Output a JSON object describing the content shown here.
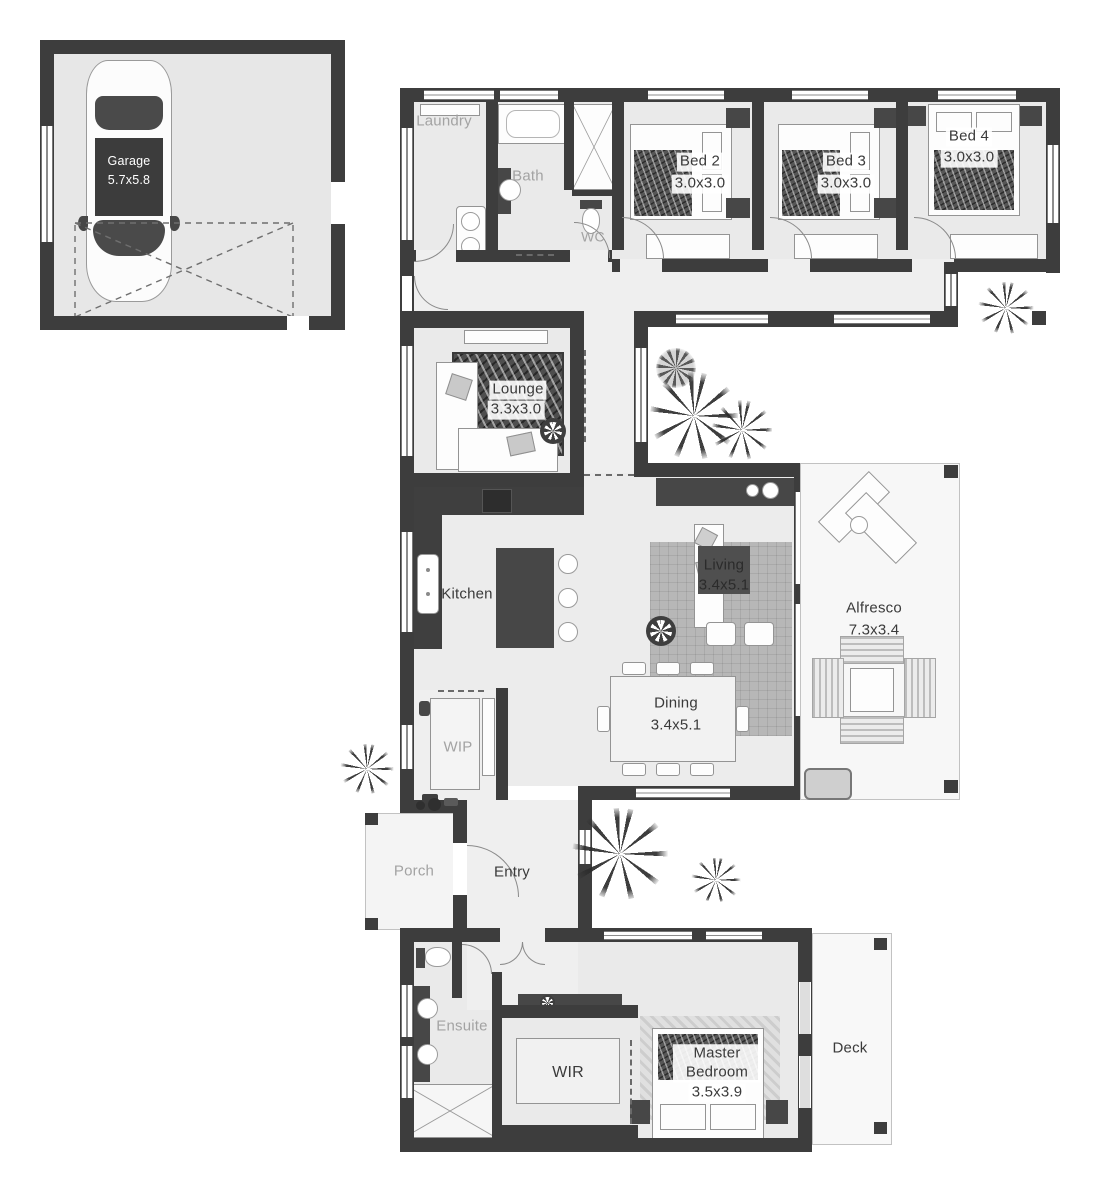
{
  "title": "House floor plan",
  "colors": {
    "wall": "#3d3d3d",
    "floor": "#eaeaea",
    "outdoor": "#f7f7f7",
    "label_dark": "#3a3a3a",
    "label_gray": "#a3a3a3"
  },
  "rooms": {
    "garage": {
      "label": "Garage",
      "dims": "5.7x5.8"
    },
    "laundry": {
      "label": "Laundry"
    },
    "bath": {
      "label": "Bath"
    },
    "wc": {
      "label": "WC"
    },
    "bed2": {
      "label": "Bed 2",
      "dims": "3.0x3.0"
    },
    "bed3": {
      "label": "Bed 3",
      "dims": "3.0x3.0"
    },
    "bed4": {
      "label": "Bed 4",
      "dims": "3.0x3.0"
    },
    "lounge": {
      "label": "Lounge",
      "dims": "3.3x3.0"
    },
    "kitchen": {
      "label": "Kitchen"
    },
    "living": {
      "label": "Living",
      "dims": "3.4x5.1"
    },
    "dining": {
      "label": "Dining",
      "dims": "3.4x5.1"
    },
    "alfresco": {
      "label": "Alfresco",
      "dims": "7.3x3.4"
    },
    "wip": {
      "label": "WIP"
    },
    "porch": {
      "label": "Porch"
    },
    "entry": {
      "label": "Entry"
    },
    "ensuite": {
      "label": "Ensuite"
    },
    "wir": {
      "label": "WIR"
    },
    "master": {
      "label": "Master Bedroom",
      "dims": "3.5x3.9"
    },
    "deck": {
      "label": "Deck"
    }
  }
}
